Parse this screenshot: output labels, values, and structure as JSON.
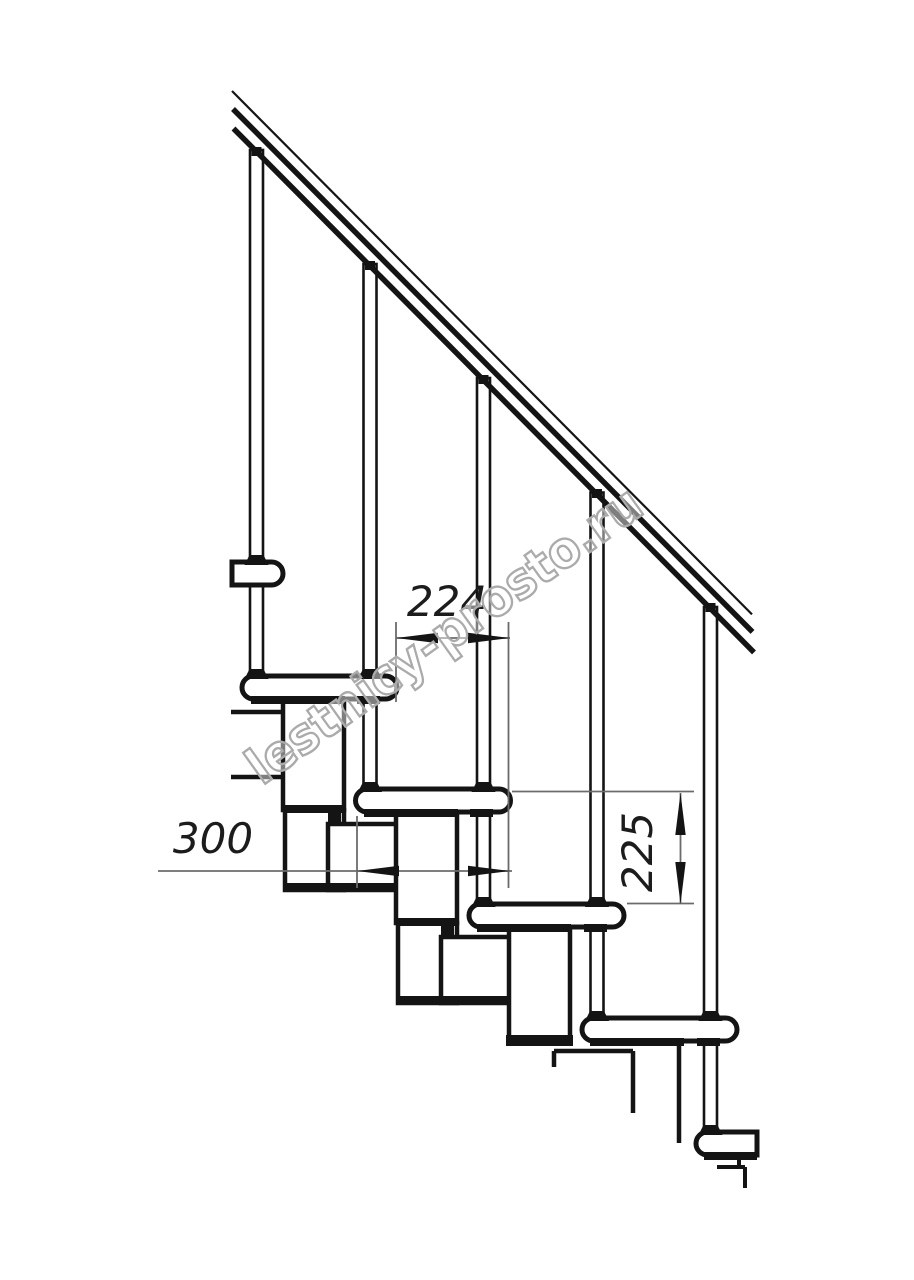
{
  "page": {
    "background": "#ffffff"
  },
  "drawing": {
    "type": "technical-drawing",
    "subject": "modular staircase side elevation with handrail, balusters, treads and central support modules",
    "line_color": "#141414",
    "dimension_line_color": "#6b6b6b",
    "visible_tread_count": 6,
    "baluster_count": 5
  },
  "dimensions": {
    "step_run": {
      "value": "224"
    },
    "tread_depth": {
      "value": "300"
    },
    "step_rise": {
      "value": "225"
    }
  },
  "watermark": {
    "text": "lestnicy-prosto.ru",
    "color": "#ababab"
  }
}
